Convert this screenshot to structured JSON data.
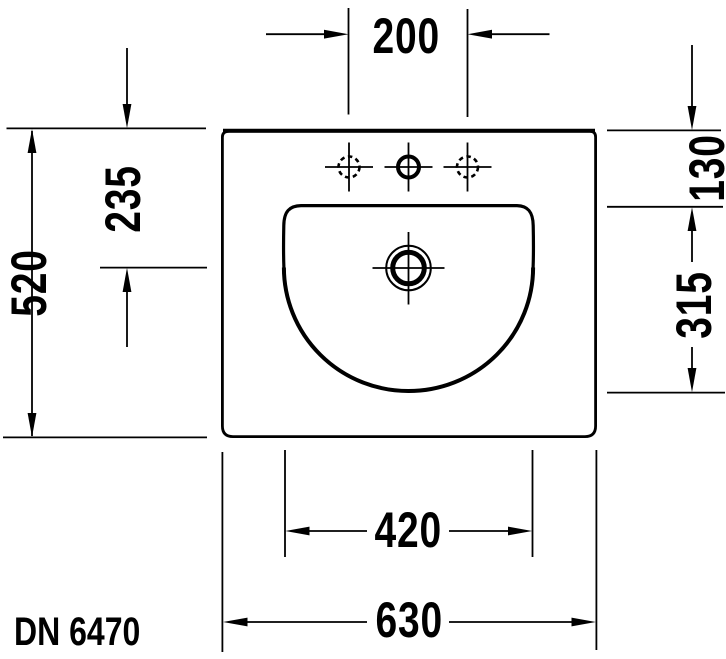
{
  "drawing": {
    "title": "washbasin-top-view-technical-drawing",
    "model_label": "DN 6470",
    "line_color": "#000000",
    "background": "#ffffff"
  },
  "dimensions": {
    "faucet_spacing": "200",
    "overall_width": "630",
    "overall_depth": "520",
    "rim_to_bowl": "130",
    "rim_to_drain": "235",
    "bowl_depth": "315",
    "bowl_width": "420"
  }
}
